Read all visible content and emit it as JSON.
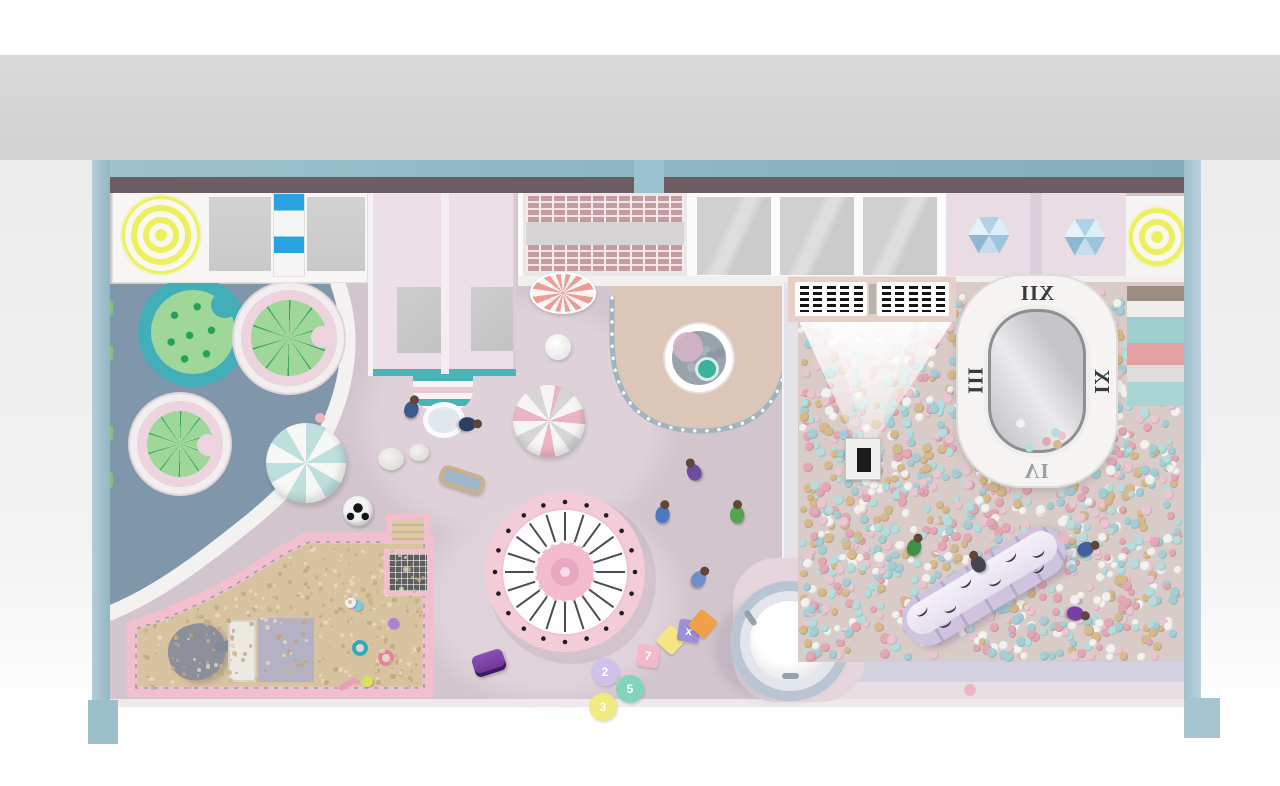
{
  "clock": {
    "numerals": [
      "XII",
      "III",
      "IX",
      "VI"
    ]
  },
  "hopscotch": {
    "circles": [
      {
        "x": 605,
        "y": 672,
        "color": "#cfc2ea",
        "label": "2"
      },
      {
        "x": 630,
        "y": 689,
        "color": "#82d4bc",
        "label": "5"
      },
      {
        "x": 603,
        "y": 707,
        "color": "#f1ea7e",
        "label": "3"
      }
    ],
    "squares": [
      {
        "x": 648,
        "y": 656,
        "color": "#f3b9cb",
        "label": "7",
        "rot": 8
      },
      {
        "x": 671,
        "y": 640,
        "color": "#f5e682",
        "label": "",
        "rot": 42
      },
      {
        "x": 689,
        "y": 631,
        "color": "#9d8fd8",
        "label": "x",
        "rot": 10
      },
      {
        "x": 703,
        "y": 624,
        "color": "#f0a04a",
        "label": "",
        "rot": 40
      }
    ]
  },
  "ballpit": {
    "count": 1500,
    "colors": [
      "#e3a8b4",
      "#b7dcdc",
      "#f3f1ee",
      "#d6b98c",
      "#e8c7d0",
      "#a7cdd4"
    ],
    "base": "#d9ccc8",
    "clock_ball_count": 6
  },
  "pool": {
    "ball_count": 9,
    "colors": [
      "#8e98a2",
      "#a9b2ba",
      "#97a0a9"
    ]
  },
  "sand": {
    "speckle_count": 300,
    "colors": [
      "#bfa57d",
      "#e9dcc2",
      "#c9b28a",
      "#ac placeholder"
    ]
  },
  "stripes": [
    {
      "color": "#9c8b80",
      "height": 15
    },
    {
      "color": "#f0eeec",
      "height": 16
    },
    {
      "color": "#9fd0cf",
      "height": 26
    },
    {
      "color": "#e2a0a0",
      "height": 22
    },
    {
      "color": "#dddcda",
      "height": 17
    },
    {
      "color": "#a8d5d4",
      "height": 24
    }
  ],
  "figures": [
    {
      "x": 412,
      "y": 407,
      "color": "#3c5a8c",
      "rot": 15
    },
    {
      "x": 470,
      "y": 424,
      "color": "#2e3f66",
      "rot": 85
    },
    {
      "x": 693,
      "y": 470,
      "color": "#6d4b9e",
      "rot": -25
    },
    {
      "x": 663,
      "y": 512,
      "color": "#4a79c4",
      "rot": 10
    },
    {
      "x": 737,
      "y": 512,
      "color": "#57a44e",
      "rot": 0
    },
    {
      "x": 700,
      "y": 577,
      "color": "#6f8fc9",
      "rot": 35
    },
    {
      "x": 915,
      "y": 545,
      "color": "#3f8f4a",
      "rot": 20
    },
    {
      "x": 1088,
      "y": 548,
      "color": "#3f5f9e",
      "rot": 65
    },
    {
      "x": 1078,
      "y": 614,
      "color": "#7a3fa5",
      "rot": 100
    },
    {
      "x": 977,
      "y": 562,
      "color": "#46454e",
      "rot": -30
    }
  ],
  "floor_toys": [
    {
      "type": "beachball",
      "x": 306,
      "y": 463,
      "r": 40
    },
    {
      "type": "soccer",
      "x": 358,
      "y": 511,
      "r": 15
    },
    {
      "type": "pebble",
      "x": 391,
      "y": 459,
      "r": 13
    },
    {
      "type": "pebble",
      "x": 419,
      "y": 452,
      "r": 10
    },
    {
      "type": "skateboard",
      "x": 462,
      "y": 480
    },
    {
      "type": "stripedball",
      "x": 549,
      "y": 421,
      "r": 36
    },
    {
      "type": "whiteball",
      "x": 558,
      "y": 347,
      "r": 13
    },
    {
      "type": "dot",
      "x": 320,
      "y": 418,
      "r": 5,
      "color": "#eab6c2"
    },
    {
      "type": "car",
      "x": 489,
      "y": 663
    }
  ],
  "sand_toys": [
    {
      "x": 352,
      "y": 640,
      "color": "#2fa8c0",
      "shape": "ring"
    },
    {
      "x": 378,
      "y": 650,
      "color": "#e87fa0",
      "shape": "ring"
    },
    {
      "x": 362,
      "y": 676,
      "color": "#d8e25a",
      "shape": "dot"
    },
    {
      "x": 338,
      "y": 681,
      "color": "#e8a0b8",
      "shape": "stick"
    },
    {
      "x": 352,
      "y": 600,
      "color": "#7ec8e0",
      "shape": "dot"
    },
    {
      "x": 388,
      "y": 618,
      "color": "#b07fd8",
      "shape": "dot"
    },
    {
      "x": 345,
      "y": 597,
      "color": "#f0f0f0",
      "shape": "dot"
    }
  ],
  "panel": {
    "panels": 2,
    "cols": 5
  },
  "carousel": {
    "spokes": 20
  },
  "caterpillar": {
    "lash_count": 8
  },
  "palette": {
    "wall_blue": "#8fb8c4",
    "floor_mauve": "#d2c5cd",
    "zone_blue": "#8096ab",
    "sand": "#d8c3a1",
    "sandbox_pink": "#f2bfcf",
    "platform_beige": "#dcc6b7",
    "carousel_pink": "#f3ccd8",
    "caterpillar_lavender": "#cfc4e0",
    "target_yellow": "#edf05e"
  }
}
